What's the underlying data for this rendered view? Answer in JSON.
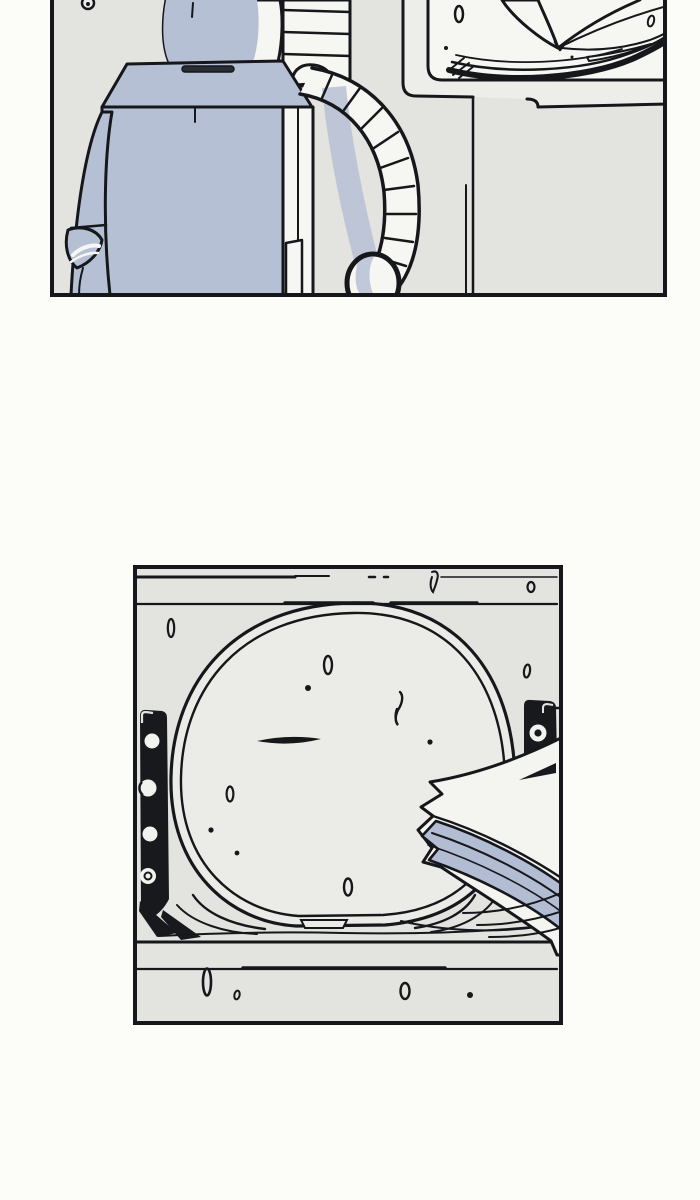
{
  "page": {
    "title": "comic strip page",
    "background": "#fcfcf8"
  },
  "colors": {
    "ink": "#15171a",
    "wall_gray": "#e3e3e0",
    "hatch_gray": "#ebebe7",
    "panel_white": "#f6f6f3",
    "paper_white": "#f4f4f1",
    "steel_blue": "#b6c0d5",
    "paper_blue": "#b2bdd3",
    "hinge_black": "#17191d",
    "page_bg": "#fcfcf8",
    "strip_gray": "#ededea"
  },
  "panels": [
    {
      "name": "robot-at-desk",
      "description": "Back view of a boxy blue-gray robot with a segmented hose arm standing beside a white desk holding an open book; panel is cropped at the top edge of the image",
      "bounds": {
        "x": 50,
        "y": 0,
        "width": 617,
        "height": 297
      }
    },
    {
      "name": "hatch-with-papers",
      "description": "Large round-cornered hatch door with black hinge plates set into a plank wall; a stack of papers leans against its lower right side",
      "bounds": {
        "x": 133,
        "y": 565,
        "width": 430,
        "height": 460
      }
    }
  ]
}
